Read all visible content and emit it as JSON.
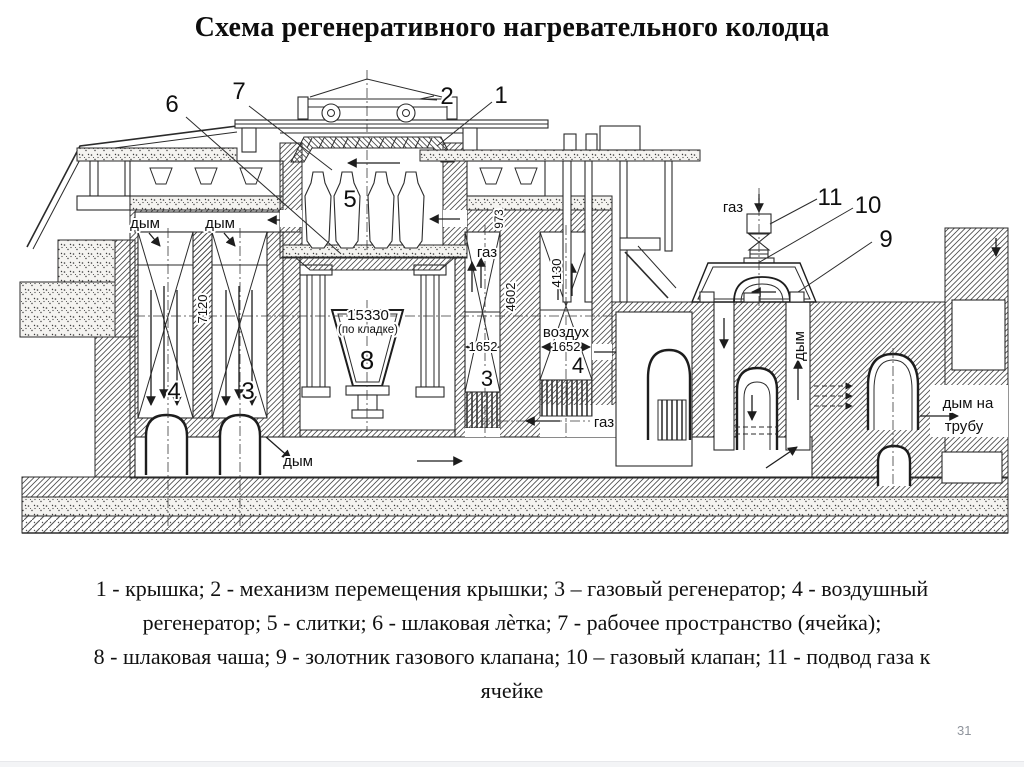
{
  "slide": {
    "title": "Схема регенеративного нагревательного колодца",
    "page_number": "31",
    "caption_lines": [
      "1 - крышка; 2 - механизм перемещения крышки; 3 – газовый регенератор; 4 - воздушный",
      "регенератор; 5 - слитки; 6 - шлаковая лѐтка; 7 - рабочее пространство (ячейка);",
      "8 - шлаковая чаша; 9 - золотник газового клапана; 10 – газовый клапан; 11 - подвод газа к",
      "ячейке"
    ]
  },
  "diagram": {
    "callouts": {
      "k1": "1",
      "k2": "2",
      "k3": "3",
      "k4": "4",
      "k5": "5",
      "k6": "6",
      "k7": "7",
      "k8": "8",
      "k9": "9",
      "k10": "10",
      "k11": "11"
    },
    "flow": {
      "smoke": "дым",
      "gas": "газ",
      "air": "воздух",
      "smoke_to_stack_line1": "дым на",
      "smoke_to_stack_line2": "трубу"
    },
    "dims": {
      "h7120": "7120",
      "w15330": "15330",
      "masonry_note": "(по кладке)",
      "h973": "973",
      "h4602": "4602",
      "h4130": "4130",
      "w1652": "1652"
    }
  }
}
